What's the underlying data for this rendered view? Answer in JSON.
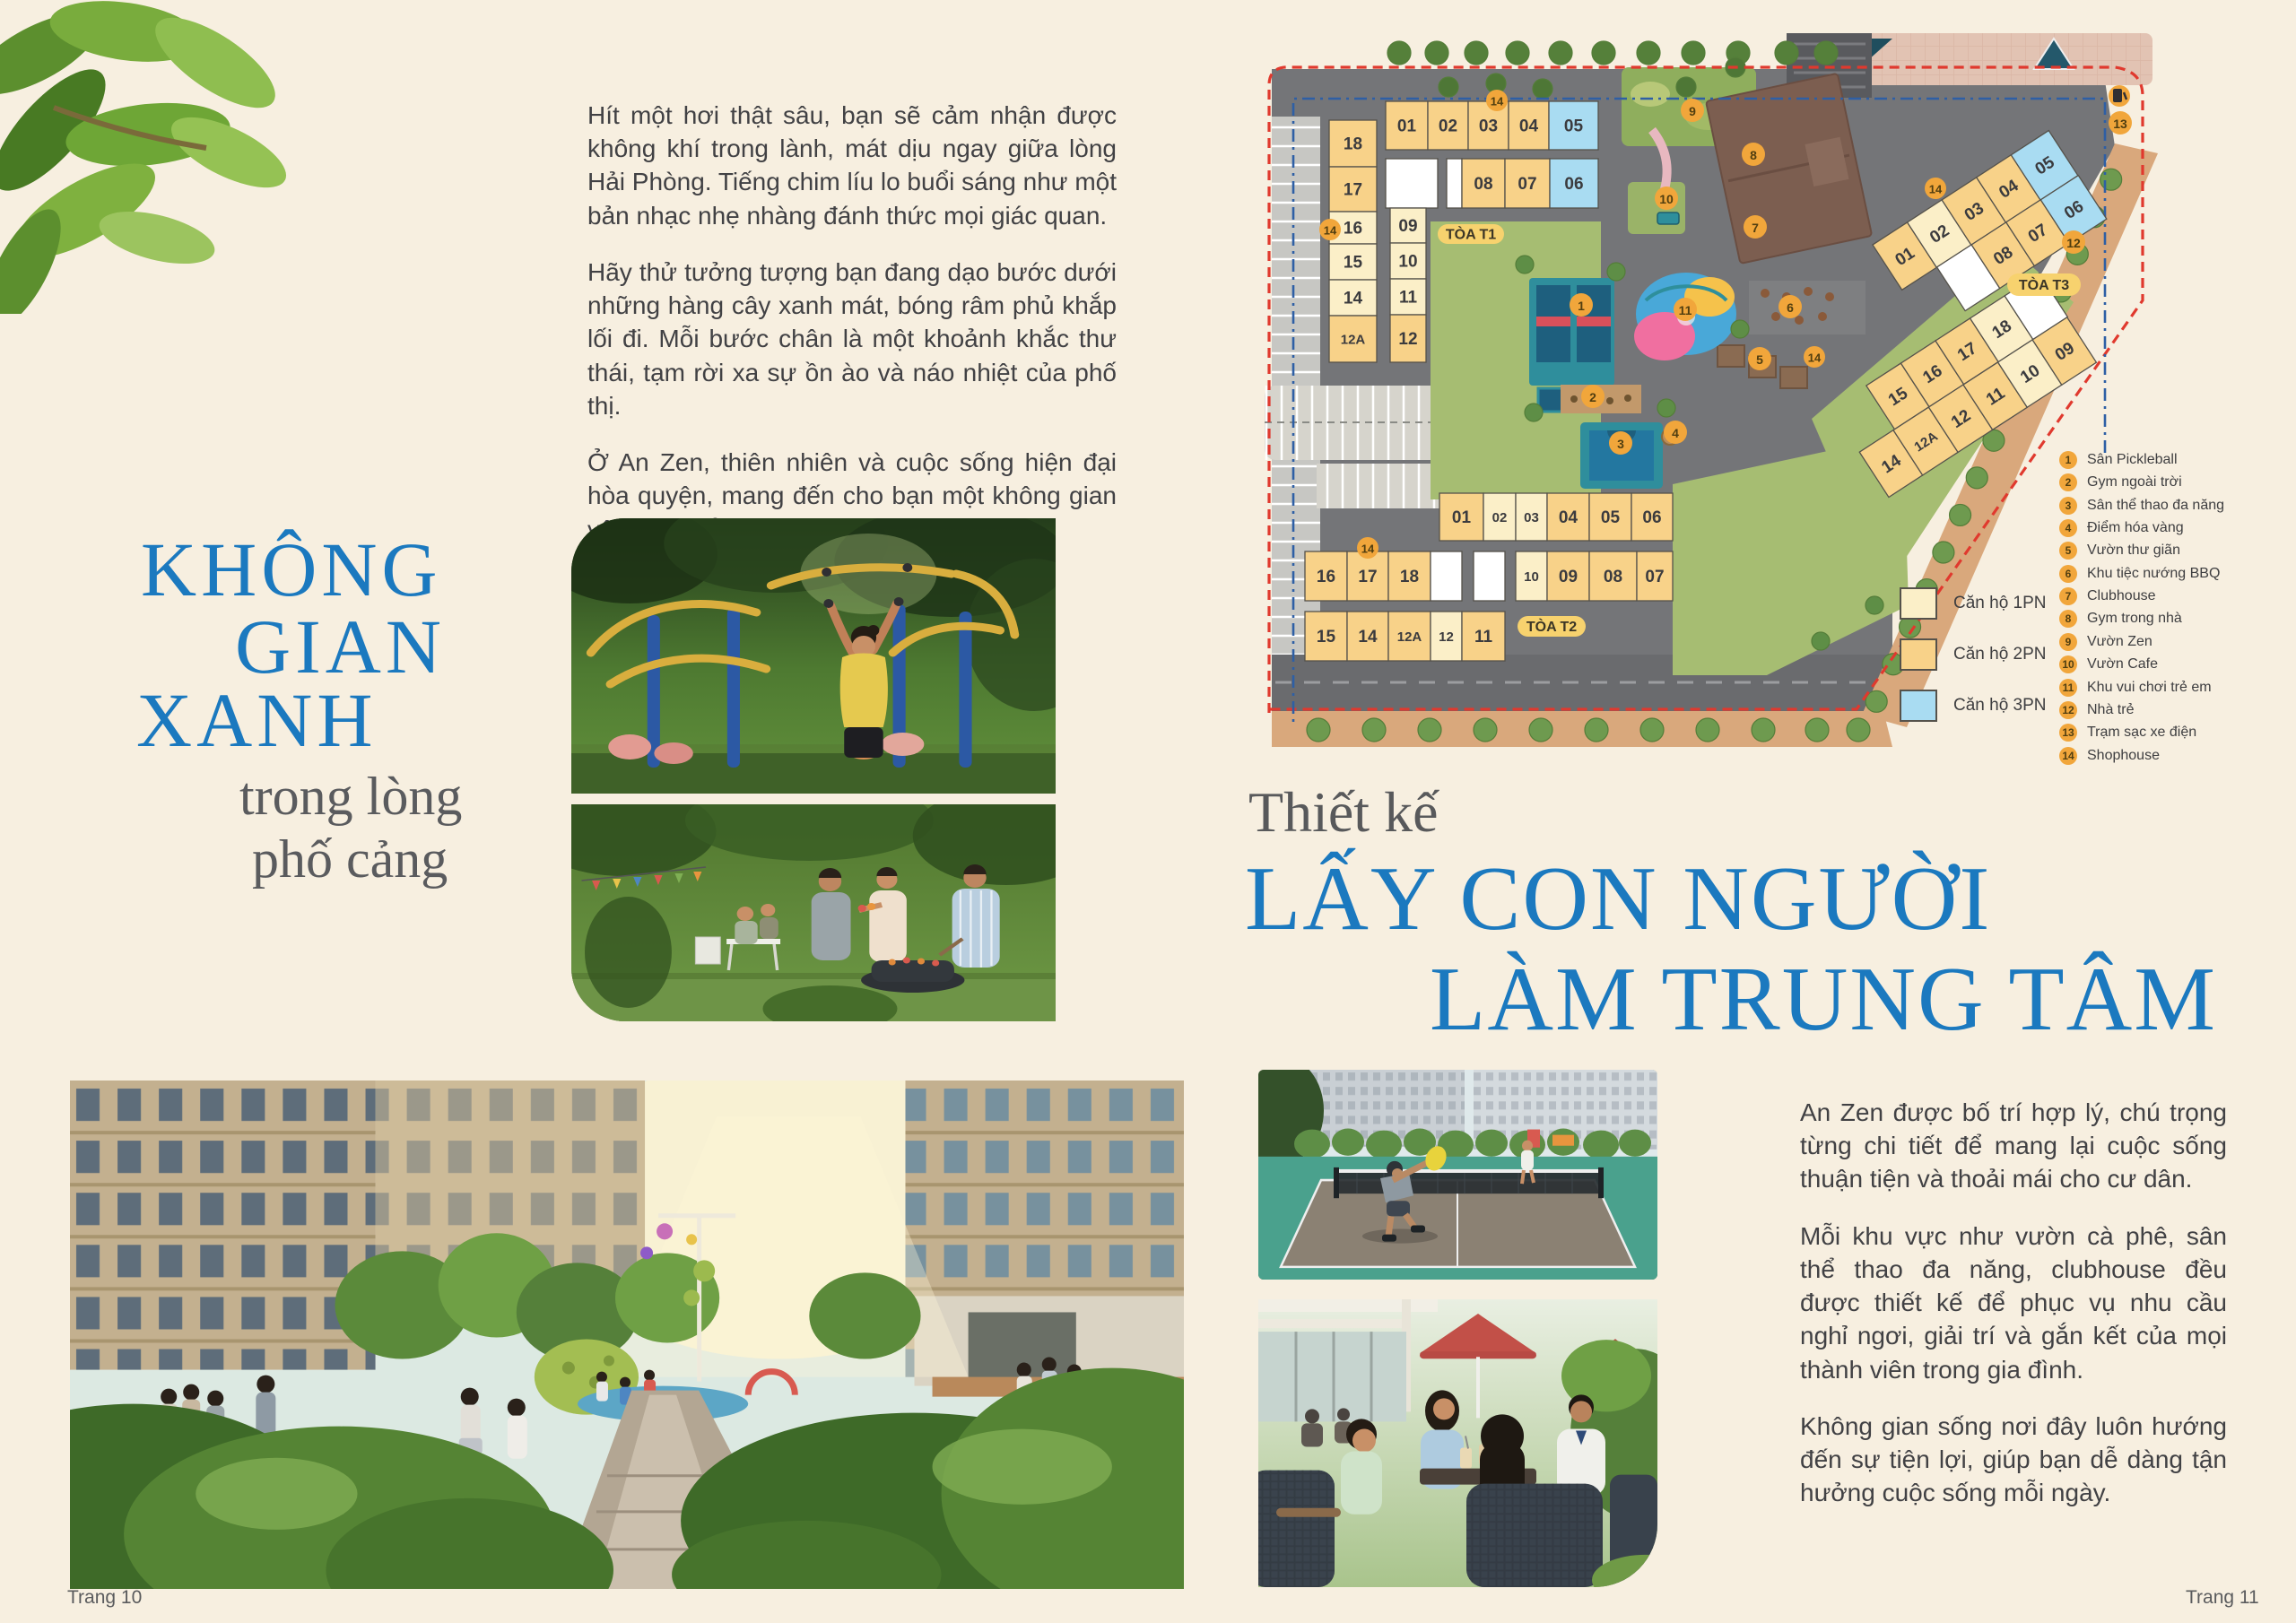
{
  "page_bg": "#F7EFE0",
  "accent_blue": "#1B79BF",
  "left": {
    "paragraphs": [
      "Hít một hơi thật sâu, bạn sẽ cảm nhận được không khí trong lành, mát dịu ngay giữa lòng Hải Phòng. Tiếng chim líu lo buổi sáng như một bản nhạc nhẹ nhàng đánh thức mọi giác quan.",
      "Hãy thử tưởng tượng bạn đang dạo bước dưới những hàng cây xanh mát, bóng râm phủ khắp lối đi. Mỗi bước chân là một khoảnh khắc thư thái, tạm rời xa sự ồn ào và náo nhiệt của phố thị.",
      "Ở An Zen, thiên nhiên và cuộc sống hiện đại hòa quyện, mang đến cho bạn một không gian yên bình để tận hưởng từng ngày."
    ],
    "headline": [
      "KHÔNG",
      "GIAN",
      "XANH"
    ],
    "subheadline": [
      "trong lòng",
      "phố cảng"
    ],
    "footer": "Trang 10"
  },
  "right": {
    "kicker": "Thiết kế",
    "title": [
      "LẤY CON NGƯỜI",
      "LÀM TRUNG TÂM"
    ],
    "paragraphs": [
      "An Zen được bố trí hợp lý, chú trọng từng chi tiết để mang lại cuộc sống thuận tiện và thoải mái cho cư dân.",
      "Mỗi khu vực như vườn cà phê, sân thể thao đa năng, clubhouse đều được thiết kế để phục vụ nhu cầu nghỉ ngơi, giải trí và gắn kết của mọi thành viên trong gia đình.",
      "Không gian sống nơi đây luôn hướng đến sự tiện lợi, giúp bạn dễ dàng tận hưởng cuộc sống mỗi ngày."
    ],
    "footer": "Trang 11"
  },
  "site_plan": {
    "colors": {
      "1pn": "#FBEFC8",
      "2pn": "#F8D289",
      "3pn": "#A9DCF2",
      "empty": "#FFFFFF",
      "badge": "#F1A63B",
      "pill": "#F7D26E",
      "boundary_red": "#E0392E",
      "boundary_blue": "#2E5FA5"
    },
    "shophouse_badge": "14",
    "towers": [
      {
        "id": "T1",
        "pill": "TÒA T1",
        "cells": [
          {
            "label": "01",
            "type": "2pn"
          },
          {
            "label": "02",
            "type": "2pn"
          },
          {
            "label": "03",
            "type": "2pn"
          },
          {
            "label": "04",
            "type": "2pn"
          },
          {
            "label": "05",
            "type": "3pn"
          },
          {
            "label": "",
            "type": "empty"
          },
          {
            "label": "",
            "type": "empty"
          },
          {
            "label": "08",
            "type": "2pn"
          },
          {
            "label": "07",
            "type": "2pn"
          },
          {
            "label": "06",
            "type": "3pn"
          },
          {
            "label": "18",
            "type": "2pn"
          },
          {
            "label": "17",
            "type": "2pn"
          },
          {
            "label": "16",
            "type": "1pn"
          },
          {
            "label": "15",
            "type": "1pn"
          },
          {
            "label": "14",
            "type": "1pn"
          },
          {
            "label": "12A",
            "type": "2pn"
          },
          {
            "label": "09",
            "type": "1pn"
          },
          {
            "label": "10",
            "type": "1pn"
          },
          {
            "label": "11",
            "type": "1pn"
          },
          {
            "label": "12",
            "type": "2pn"
          }
        ]
      },
      {
        "id": "T2",
        "pill": "TÒA T2",
        "cells": [
          {
            "label": "01",
            "type": "2pn"
          },
          {
            "label": "02",
            "type": "1pn"
          },
          {
            "label": "03",
            "type": "1pn"
          },
          {
            "label": "04",
            "type": "2pn"
          },
          {
            "label": "05",
            "type": "2pn"
          },
          {
            "label": "06",
            "type": "2pn"
          },
          {
            "label": "16",
            "type": "2pn"
          },
          {
            "label": "17",
            "type": "2pn"
          },
          {
            "label": "18",
            "type": "2pn"
          },
          {
            "label": "",
            "type": "empty"
          },
          {
            "label": "",
            "type": "empty"
          },
          {
            "label": "10",
            "type": "1pn"
          },
          {
            "label": "09",
            "type": "2pn"
          },
          {
            "label": "08",
            "type": "2pn"
          },
          {
            "label": "07",
            "type": "2pn"
          },
          {
            "label": "15",
            "type": "2pn"
          },
          {
            "label": "14",
            "type": "2pn"
          },
          {
            "label": "12A",
            "type": "2pn"
          },
          {
            "label": "12",
            "type": "1pn"
          },
          {
            "label": "11",
            "type": "2pn"
          }
        ]
      },
      {
        "id": "T3",
        "pill": "TÒA T3",
        "cells": [
          {
            "label": "01",
            "type": "2pn"
          },
          {
            "label": "02",
            "type": "1pn"
          },
          {
            "label": "03",
            "type": "2pn"
          },
          {
            "label": "04",
            "type": "2pn"
          },
          {
            "label": "05",
            "type": "3pn"
          },
          {
            "label": "",
            "type": "empty"
          },
          {
            "label": "08",
            "type": "2pn"
          },
          {
            "label": "07",
            "type": "2pn"
          },
          {
            "label": "06",
            "type": "3pn"
          },
          {
            "label": "15",
            "type": "2pn"
          },
          {
            "label": "16",
            "type": "2pn"
          },
          {
            "label": "17",
            "type": "2pn"
          },
          {
            "label": "18",
            "type": "1pn"
          },
          {
            "label": "",
            "type": "empty"
          },
          {
            "label": "14",
            "type": "2pn"
          },
          {
            "label": "12A",
            "type": "2pn"
          },
          {
            "label": "12",
            "type": "2pn"
          },
          {
            "label": "11",
            "type": "2pn"
          },
          {
            "label": "10",
            "type": "1pn"
          },
          {
            "label": "09",
            "type": "2pn"
          }
        ]
      }
    ],
    "amenities": [
      {
        "num": "1",
        "label": "Sân Pickleball"
      },
      {
        "num": "2",
        "label": "Gym ngoài trời"
      },
      {
        "num": "3",
        "label": "Sân thể thao đa năng"
      },
      {
        "num": "4",
        "label": "Điểm hóa vàng"
      },
      {
        "num": "5",
        "label": "Vườn thư giãn"
      },
      {
        "num": "6",
        "label": "Khu tiệc nướng BBQ"
      },
      {
        "num": "7",
        "label": "Clubhouse"
      },
      {
        "num": "8",
        "label": "Gym trong nhà"
      },
      {
        "num": "9",
        "label": "Vườn Zen"
      },
      {
        "num": "10",
        "label": "Vườn Cafe"
      },
      {
        "num": "11",
        "label": "Khu vui chơi trẻ em"
      },
      {
        "num": "12",
        "label": "Nhà trẻ"
      },
      {
        "num": "13",
        "label": "Trạm sạc xe điện"
      },
      {
        "num": "14",
        "label": "Shophouse"
      }
    ],
    "unit_types": [
      {
        "label": "Căn hộ 1PN",
        "type": "1pn"
      },
      {
        "label": "Căn hộ 2PN",
        "type": "2pn"
      },
      {
        "label": "Căn hộ 3PN",
        "type": "3pn"
      }
    ]
  }
}
